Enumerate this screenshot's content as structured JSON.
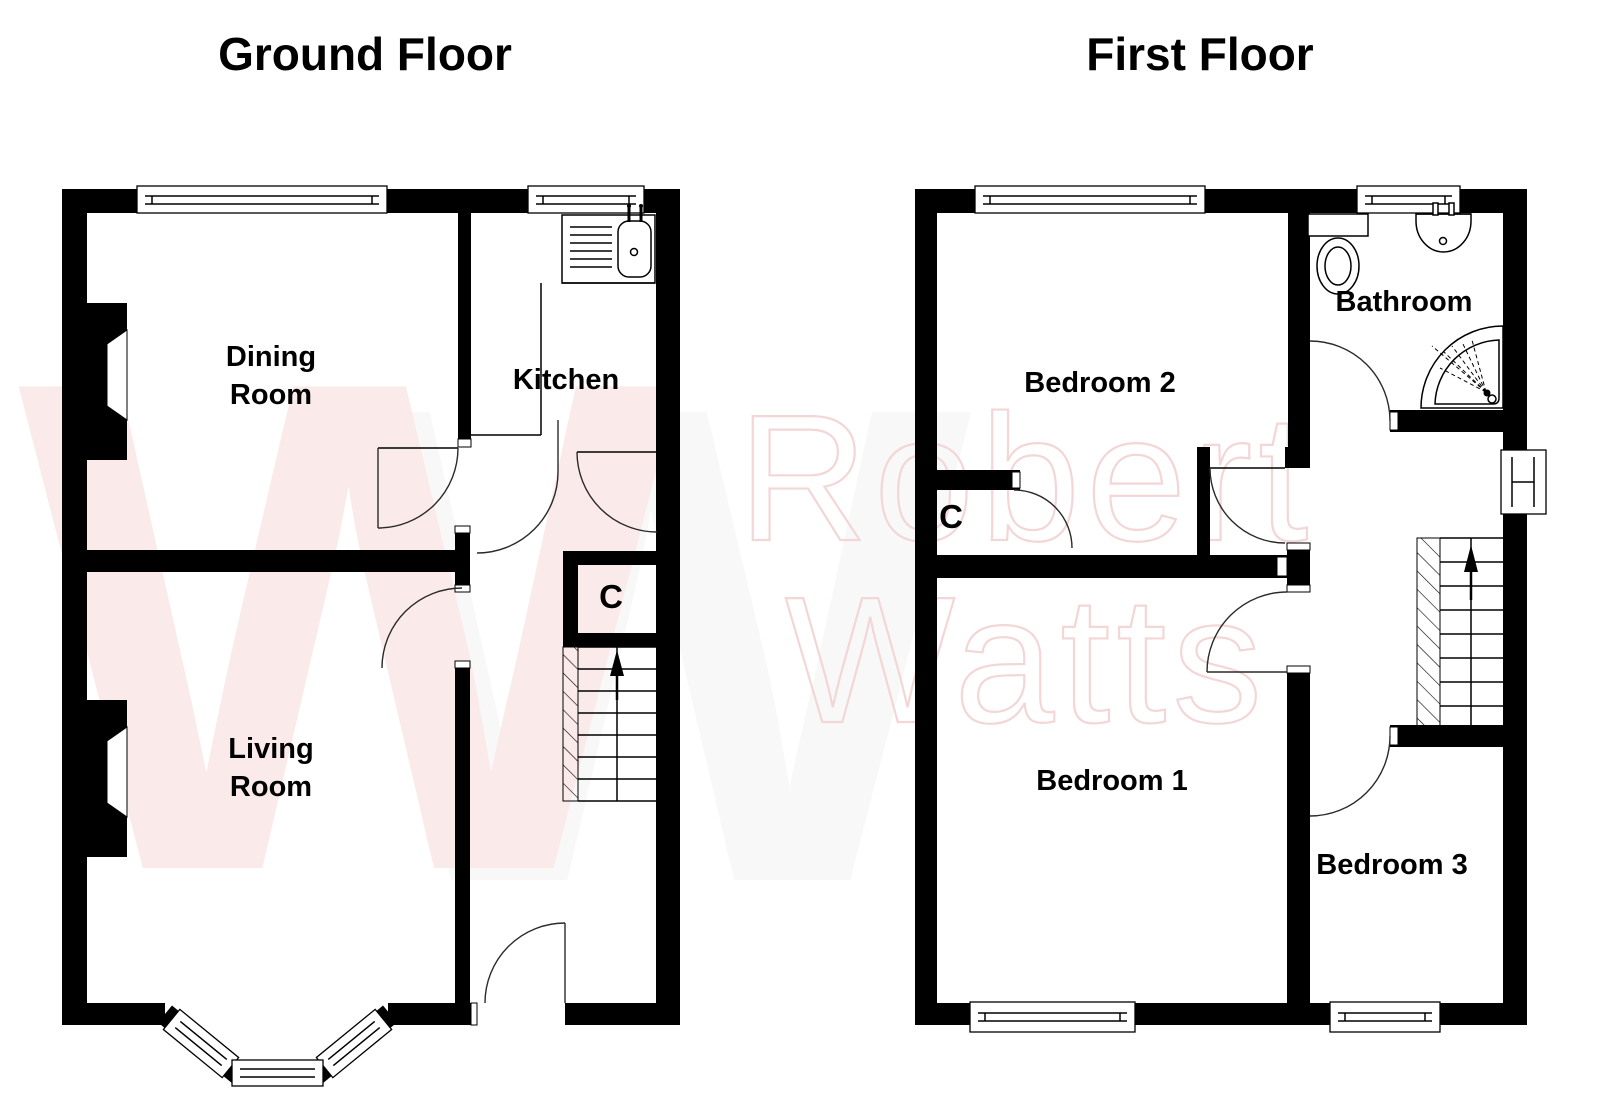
{
  "titles": {
    "ground": "Ground Floor",
    "first": "First Floor"
  },
  "ground_floor": {
    "rooms": {
      "dining_line1": "Dining",
      "dining_line2": "Room",
      "living_line1": "Living",
      "living_line2": "Room",
      "kitchen": "Kitchen",
      "cupboard": "C"
    }
  },
  "first_floor": {
    "rooms": {
      "bedroom1": "Bedroom 1",
      "bedroom2": "Bedroom 2",
      "bedroom3": "Bedroom 3",
      "bathroom": "Bathroom",
      "cupboard": "C"
    }
  },
  "watermark": {
    "letter": "W",
    "letter2": "W",
    "line1": "Robert",
    "line2": "Watts"
  },
  "icons": {
    "kitchen_sink": "sink-with-drainer-icon",
    "toilet": "toilet-icon",
    "basin": "wash-basin-icon",
    "shower": "corner-shower-icon",
    "stairs_up_ground": "up-arrow-icon",
    "stairs_up_first": "up-arrow-icon"
  },
  "colors": {
    "background": "#ffffff",
    "wall": "#000000",
    "watermark_w": "#fbeaea",
    "watermark_text": "#f3d6d6"
  }
}
